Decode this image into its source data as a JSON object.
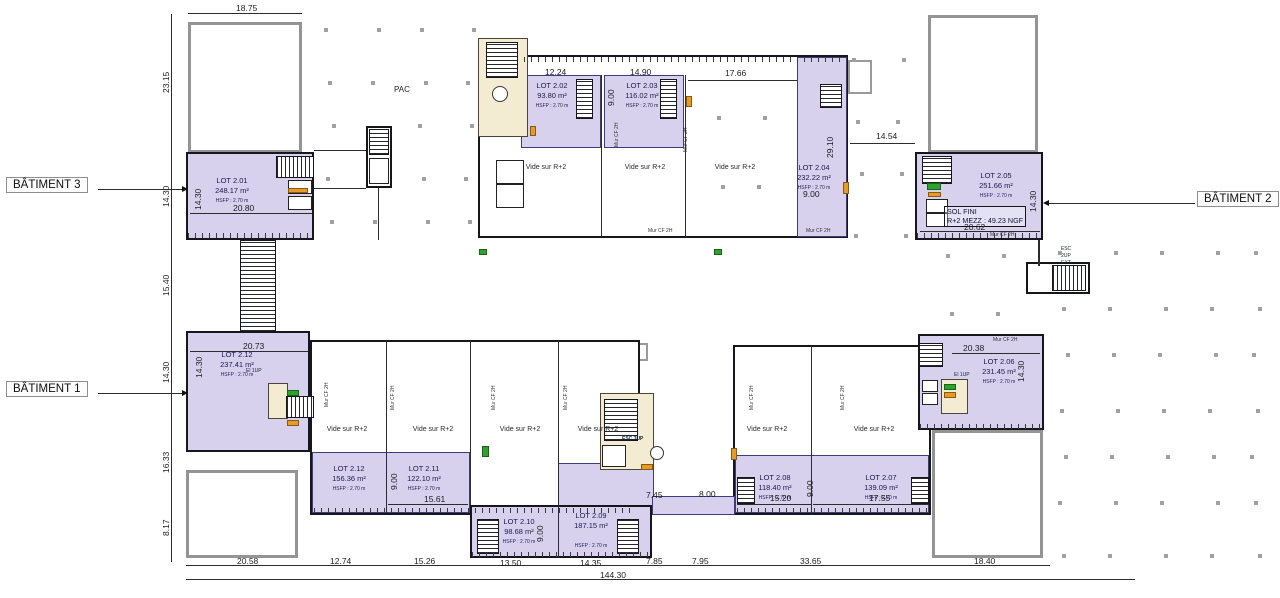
{
  "drawing": {
    "buildings": [
      {
        "id": "batiment-3",
        "label": "BÂTIMENT 3"
      },
      {
        "id": "batiment-1",
        "label": "BÂTIMENT 1"
      },
      {
        "id": "batiment-2",
        "label": "BÂTIMENT 2"
      }
    ],
    "lots": [
      {
        "name": "LOT 2.01",
        "area": "248.17 m²",
        "hsfp": "HSFP : 2.70 m",
        "cx": 232,
        "y": 176
      },
      {
        "name": "LOT 2.02",
        "area": "93.80 m²",
        "hsfp": "HSFP : 2.70 m",
        "cx": 552,
        "y": 81
      },
      {
        "name": "LOT 2.03",
        "area": "116.02 m²",
        "hsfp": "HSFP : 2.70 m",
        "cx": 642,
        "y": 81
      },
      {
        "name": "LOT 2.04",
        "area": "232.22 m²",
        "hsfp": "HSFP : 2.70 m",
        "cx": 814,
        "y": 163
      },
      {
        "name": "LOT 2.05",
        "area": "251.66 m²",
        "hsfp": "HSFP : 2.70 m",
        "cx": 996,
        "y": 171
      },
      {
        "name": "LOT 2.06",
        "area": "231.45 m²",
        "hsfp": "HSFP : 2.70 m",
        "cx": 999,
        "y": 357
      },
      {
        "name": "LOT 2.07",
        "area": "139.09 m²",
        "hsfp": "HSFP : 2.70 m",
        "cx": 881,
        "y": 473
      },
      {
        "name": "LOT 2.08",
        "area": "118.40 m²",
        "hsfp": "HSFP : 2.70 m",
        "cx": 775,
        "y": 473
      },
      {
        "name": "LOT 2.09",
        "area": "187.15 m²",
        "hsfp": "HSFP : 2.70 m",
        "cx": 591,
        "y": 511,
        "hsfp_gap": 12
      },
      {
        "name": "LOT 2.10",
        "area": "98.68 m²",
        "hsfp": "HSFP : 2.70 m",
        "cx": 519,
        "y": 517
      },
      {
        "name": "LOT 2.11",
        "area": "122.10 m²",
        "hsfp": "HSFP : 2.70 m",
        "cx": 424,
        "y": 464
      },
      {
        "name": "LOT 2.12",
        "area": "156.36 m²",
        "hsfp": "HSFP : 2.70 m",
        "cx": 349,
        "y": 464
      },
      {
        "name": "LOT 2.12",
        "area": "237.41 m²",
        "hsfp": "HSFP : 2.70 m",
        "cx": 237,
        "y": 350
      }
    ],
    "vide": {
      "text": "Vide sur R+2",
      "positions": [
        {
          "x": 546,
          "y": 164
        },
        {
          "x": 645,
          "y": 164
        },
        {
          "x": 735,
          "y": 164
        },
        {
          "x": 347,
          "y": 426
        },
        {
          "x": 433,
          "y": 426
        },
        {
          "x": 520,
          "y": 426
        },
        {
          "x": 598,
          "y": 426
        },
        {
          "x": 767,
          "y": 426
        },
        {
          "x": 874,
          "y": 426
        }
      ]
    },
    "murcf": {
      "text": "Mur CF 2H",
      "positions": [
        {
          "x": 648,
          "y": 228
        },
        {
          "x": 806,
          "y": 228
        },
        {
          "x": 990,
          "y": 232
        },
        {
          "x": 993,
          "y": 337
        },
        {
          "x": 614,
          "y": 147,
          "r": 1
        },
        {
          "x": 683,
          "y": 152,
          "r": 1
        },
        {
          "x": 324,
          "y": 407,
          "r": 1
        },
        {
          "x": 390,
          "y": 410,
          "r": 1
        },
        {
          "x": 491,
          "y": 410,
          "r": 1
        },
        {
          "x": 563,
          "y": 410,
          "r": 1
        },
        {
          "x": 749,
          "y": 410,
          "r": 1
        },
        {
          "x": 840,
          "y": 410,
          "r": 1
        }
      ]
    },
    "dimensions": [
      {
        "t": "18.75",
        "x": 236,
        "y": 3
      },
      {
        "t": "23.15",
        "x": 161,
        "y": 93,
        "r": 1
      },
      {
        "t": "14.30",
        "x": 161,
        "y": 207,
        "r": 1
      },
      {
        "t": "15.40",
        "x": 161,
        "y": 296,
        "r": 1
      },
      {
        "t": "14.30",
        "x": 161,
        "y": 383,
        "r": 1
      },
      {
        "t": "16.33",
        "x": 161,
        "y": 473,
        "r": 1
      },
      {
        "t": "8.17",
        "x": 161,
        "y": 536,
        "r": 1
      },
      {
        "t": "14.30",
        "x": 193,
        "y": 210,
        "r": 1
      },
      {
        "t": "20.80",
        "x": 233,
        "y": 203
      },
      {
        "t": "12.24",
        "x": 545,
        "y": 67
      },
      {
        "t": "14.90",
        "x": 630,
        "y": 67
      },
      {
        "t": "9.00",
        "x": 606,
        "y": 106,
        "r": 1
      },
      {
        "t": "17.66",
        "x": 725,
        "y": 68
      },
      {
        "t": "29.10",
        "x": 825,
        "y": 158,
        "r": 1
      },
      {
        "t": "9.00",
        "x": 803,
        "y": 189
      },
      {
        "t": "14.54",
        "x": 876,
        "y": 131
      },
      {
        "t": "14.30",
        "x": 1028,
        "y": 212,
        "r": 1
      },
      {
        "t": "20.62",
        "x": 964,
        "y": 222
      },
      {
        "t": "20.73",
        "x": 243,
        "y": 341
      },
      {
        "t": "14.30",
        "x": 194,
        "y": 378,
        "r": 1
      },
      {
        "t": "20.38",
        "x": 963,
        "y": 343
      },
      {
        "t": "14.30",
        "x": 1016,
        "y": 382,
        "r": 1
      },
      {
        "t": "9.00",
        "x": 389,
        "y": 490,
        "r": 1
      },
      {
        "t": "15.61",
        "x": 424,
        "y": 494
      },
      {
        "t": "9.00",
        "x": 535,
        "y": 542,
        "r": 1
      },
      {
        "t": "7.45",
        "x": 646,
        "y": 490
      },
      {
        "t": "8.00",
        "x": 699,
        "y": 489
      },
      {
        "t": "9.00",
        "x": 805,
        "y": 497,
        "r": 1
      },
      {
        "t": "15.20",
        "x": 770,
        "y": 493
      },
      {
        "t": "17.55",
        "x": 869,
        "y": 493
      },
      {
        "t": "20.58",
        "x": 237,
        "y": 556
      },
      {
        "t": "12.74",
        "x": 330,
        "y": 556
      },
      {
        "t": "15.26",
        "x": 414,
        "y": 556
      },
      {
        "t": "13.50",
        "x": 500,
        "y": 558
      },
      {
        "t": "14.35",
        "x": 580,
        "y": 558
      },
      {
        "t": "7.85",
        "x": 646,
        "y": 556
      },
      {
        "t": "7.95",
        "x": 692,
        "y": 556
      },
      {
        "t": "33.65",
        "x": 800,
        "y": 556
      },
      {
        "t": "18.40",
        "x": 974,
        "y": 556
      },
      {
        "t": "144.30",
        "x": 600,
        "y": 570
      }
    ],
    "annotations": {
      "pac": "PAC",
      "esc_center": "ESC 3UP",
      "esc_ext": "ESC\n2UP\nEXT",
      "elevator_a": "El 1UP",
      "elevator_b": "El 1UP",
      "sol_fini_line1": "SOL FINI",
      "sol_fini_line2": "R+2 MEZZ : 49.23 NGF"
    },
    "colors": {
      "lot_fill": "#d8d1ee",
      "lot_border": "#3d3d7c",
      "wall": "#16161e",
      "stair_fill": "#f4ebd3",
      "shell_border": "#949494",
      "accent_green": "#2ea12e",
      "accent_orange": "#e69b28",
      "dot": "#a0a0a0"
    }
  }
}
